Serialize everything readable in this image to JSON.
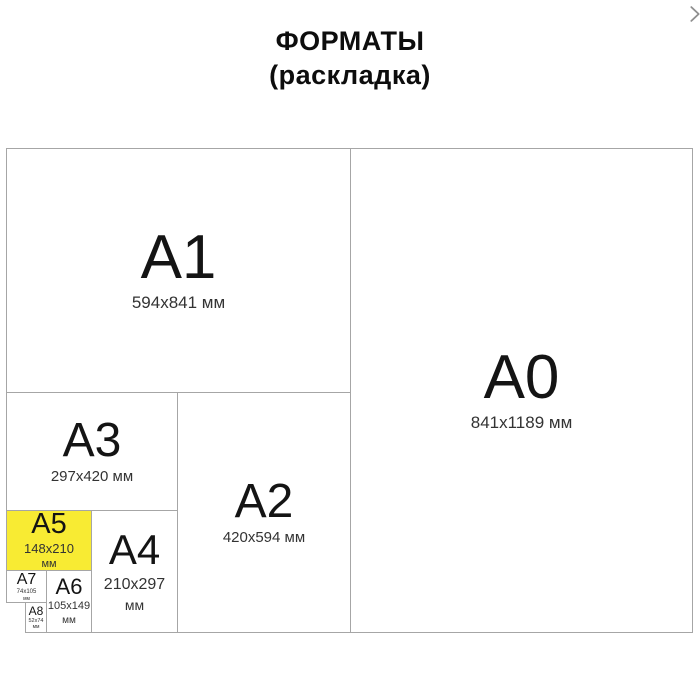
{
  "title": {
    "line1": "ФОРМАТЫ",
    "line2": "(раскладка)"
  },
  "nav": {
    "next_icon": "chevron-right"
  },
  "colors": {
    "highlight_yellow": "#f8eb33",
    "border_gray": "#a6a6a6",
    "arrow_gray": "#8f8f8f"
  },
  "formats": [
    {
      "id": "A1",
      "label": "A1",
      "dims": "594x841 мм"
    },
    {
      "id": "A0",
      "label": "A0",
      "dims": "841x1189 мм"
    },
    {
      "id": "A3",
      "label": "A3",
      "dims": "297x420 мм"
    },
    {
      "id": "A2",
      "label": "A2",
      "dims": "420x594 мм"
    },
    {
      "id": "A5",
      "label": "A5",
      "dims": "148x210",
      "unit": "мм",
      "highlighted": true
    },
    {
      "id": "A4",
      "label": "A4",
      "dims": "210x297",
      "unit": "мм"
    },
    {
      "id": "A7",
      "label": "A7",
      "dims": "74x105",
      "unit": "мм"
    },
    {
      "id": "A6",
      "label": "A6",
      "dims": "105x149",
      "unit": "мм"
    },
    {
      "id": "A8",
      "label": "A8",
      "dims": "52x74",
      "unit": "мм"
    }
  ]
}
